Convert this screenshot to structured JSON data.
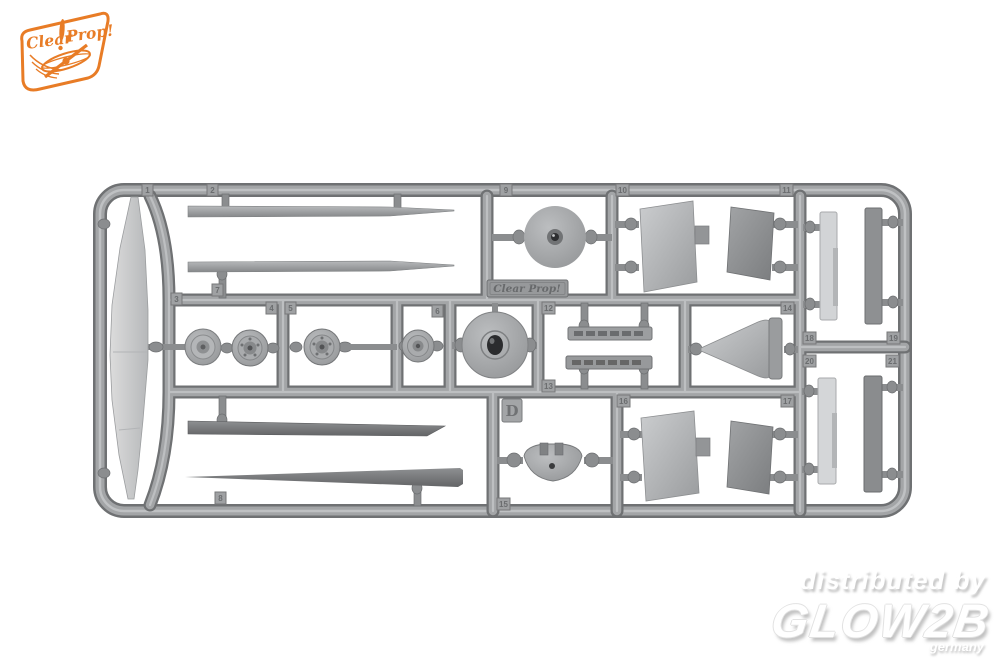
{
  "canvas": {
    "width": 1000,
    "height": 667,
    "background_color": "#ffffff"
  },
  "brand_logo": {
    "word_left": "Clear",
    "word_right": "Prop!",
    "accent_color": "#e87c26"
  },
  "sprue": {
    "runner_letter": "D",
    "nameplate_text": "Clear Prop!",
    "plastic_color": "#a3a5a7",
    "part_tags": [
      "1",
      "2",
      "3",
      "4",
      "5",
      "6",
      "7",
      "8",
      "9",
      "10",
      "11",
      "12",
      "13",
      "14",
      "15",
      "16",
      "17",
      "18",
      "19",
      "20",
      "21"
    ]
  },
  "watermark": {
    "line1": "distributed by",
    "line2": "GLOW2B",
    "line3": "germany",
    "text_color": "#ffffff",
    "shadow_color": "#c2c2c2"
  }
}
